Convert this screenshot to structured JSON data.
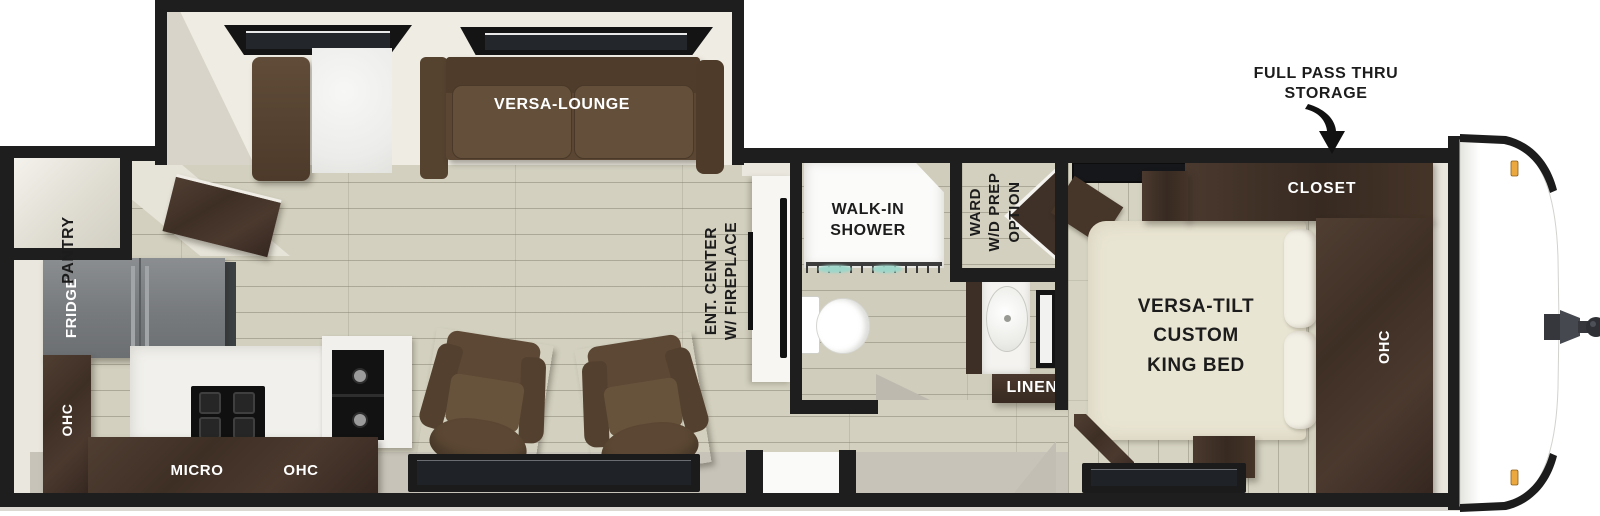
{
  "floorplan": {
    "title": "travel-trailer-floorplan",
    "labels": {
      "versa_lounge": "VERSA-LOUNGE",
      "pantry": "PANTRY",
      "fridge": "FRIDGE",
      "ohc_left": "OHC",
      "micro": "MICRO",
      "ohc_kitchen": "OHC",
      "ent_center_1": "ENT. CENTER",
      "ent_center_2": "W/ FIREPLACE",
      "shower_1": "WALK-IN",
      "shower_2": "SHOWER",
      "ward_1": "WARD",
      "ward_2": "W/D PREP",
      "ward_3": "OPTION",
      "linen": "LINEN",
      "bed_1": "VERSA-TILT",
      "bed_2": "CUSTOM",
      "bed_3": "KING BED",
      "closet": "CLOSET",
      "ohc_bedroom": "OHC",
      "storage_1": "FULL PASS THRU",
      "storage_2": "STORAGE"
    },
    "colors": {
      "wall": "#1e1e1e",
      "floor": "#d3d0bf",
      "trim_cream": "#eae7de",
      "sill_gray": "#c7c3b8",
      "sofa_brown": "#5d4835",
      "cabinet_wood": "#42322a",
      "fridge_gray": "#7d8083",
      "bed_cream": "#e9e5d3",
      "marker_amber": "#eaa83e",
      "hitch_gray": "#44464c",
      "shower_glass_teal": "#9ed6c9"
    }
  }
}
